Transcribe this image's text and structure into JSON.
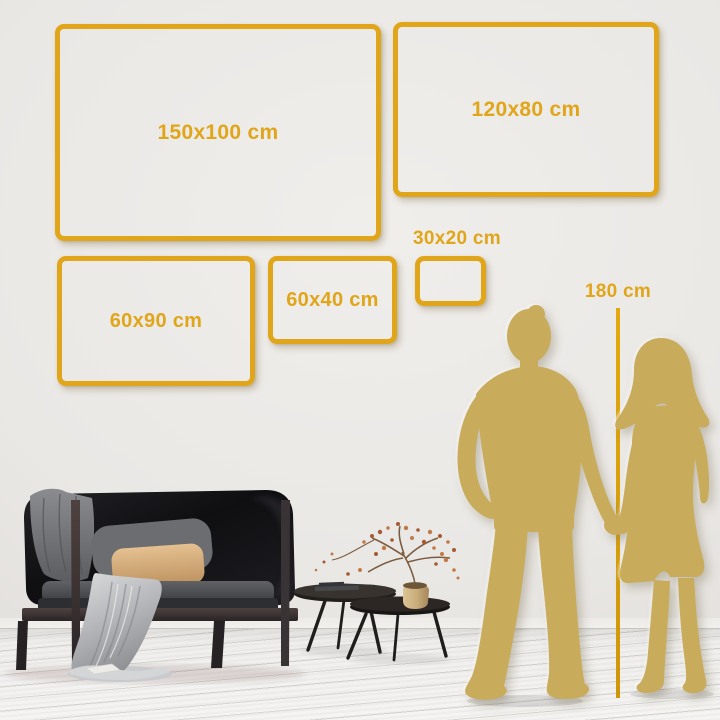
{
  "size_guide": {
    "frames": [
      {
        "label": "150x100 cm",
        "width_cm": 150,
        "height_cm": 100
      },
      {
        "label": "120x80 cm",
        "width_cm": 120,
        "height_cm": 80
      },
      {
        "label": "60x90 cm",
        "width_cm": 60,
        "height_cm": 90
      },
      {
        "label": "60x40 cm",
        "width_cm": 60,
        "height_cm": 40
      },
      {
        "label": "30x20 cm",
        "width_cm": 30,
        "height_cm": 20
      }
    ],
    "height_reference": {
      "label": "180 cm",
      "height_cm": 180
    }
  },
  "colors": {
    "accent_gold": "#E1A51A",
    "ruler_gold": "#D89E0C",
    "silhouette_gold": "#C8AC5C",
    "wall": "#EAE8E5",
    "floor": "#F3F2F0"
  },
  "scene": {
    "items": [
      "dark-sofa",
      "gray-blanket",
      "tan-pillow",
      "gray-pillow",
      "nesting-coffee-tables",
      "books",
      "plant-in-brass-pot",
      "man-silhouette",
      "woman-silhouette"
    ]
  }
}
